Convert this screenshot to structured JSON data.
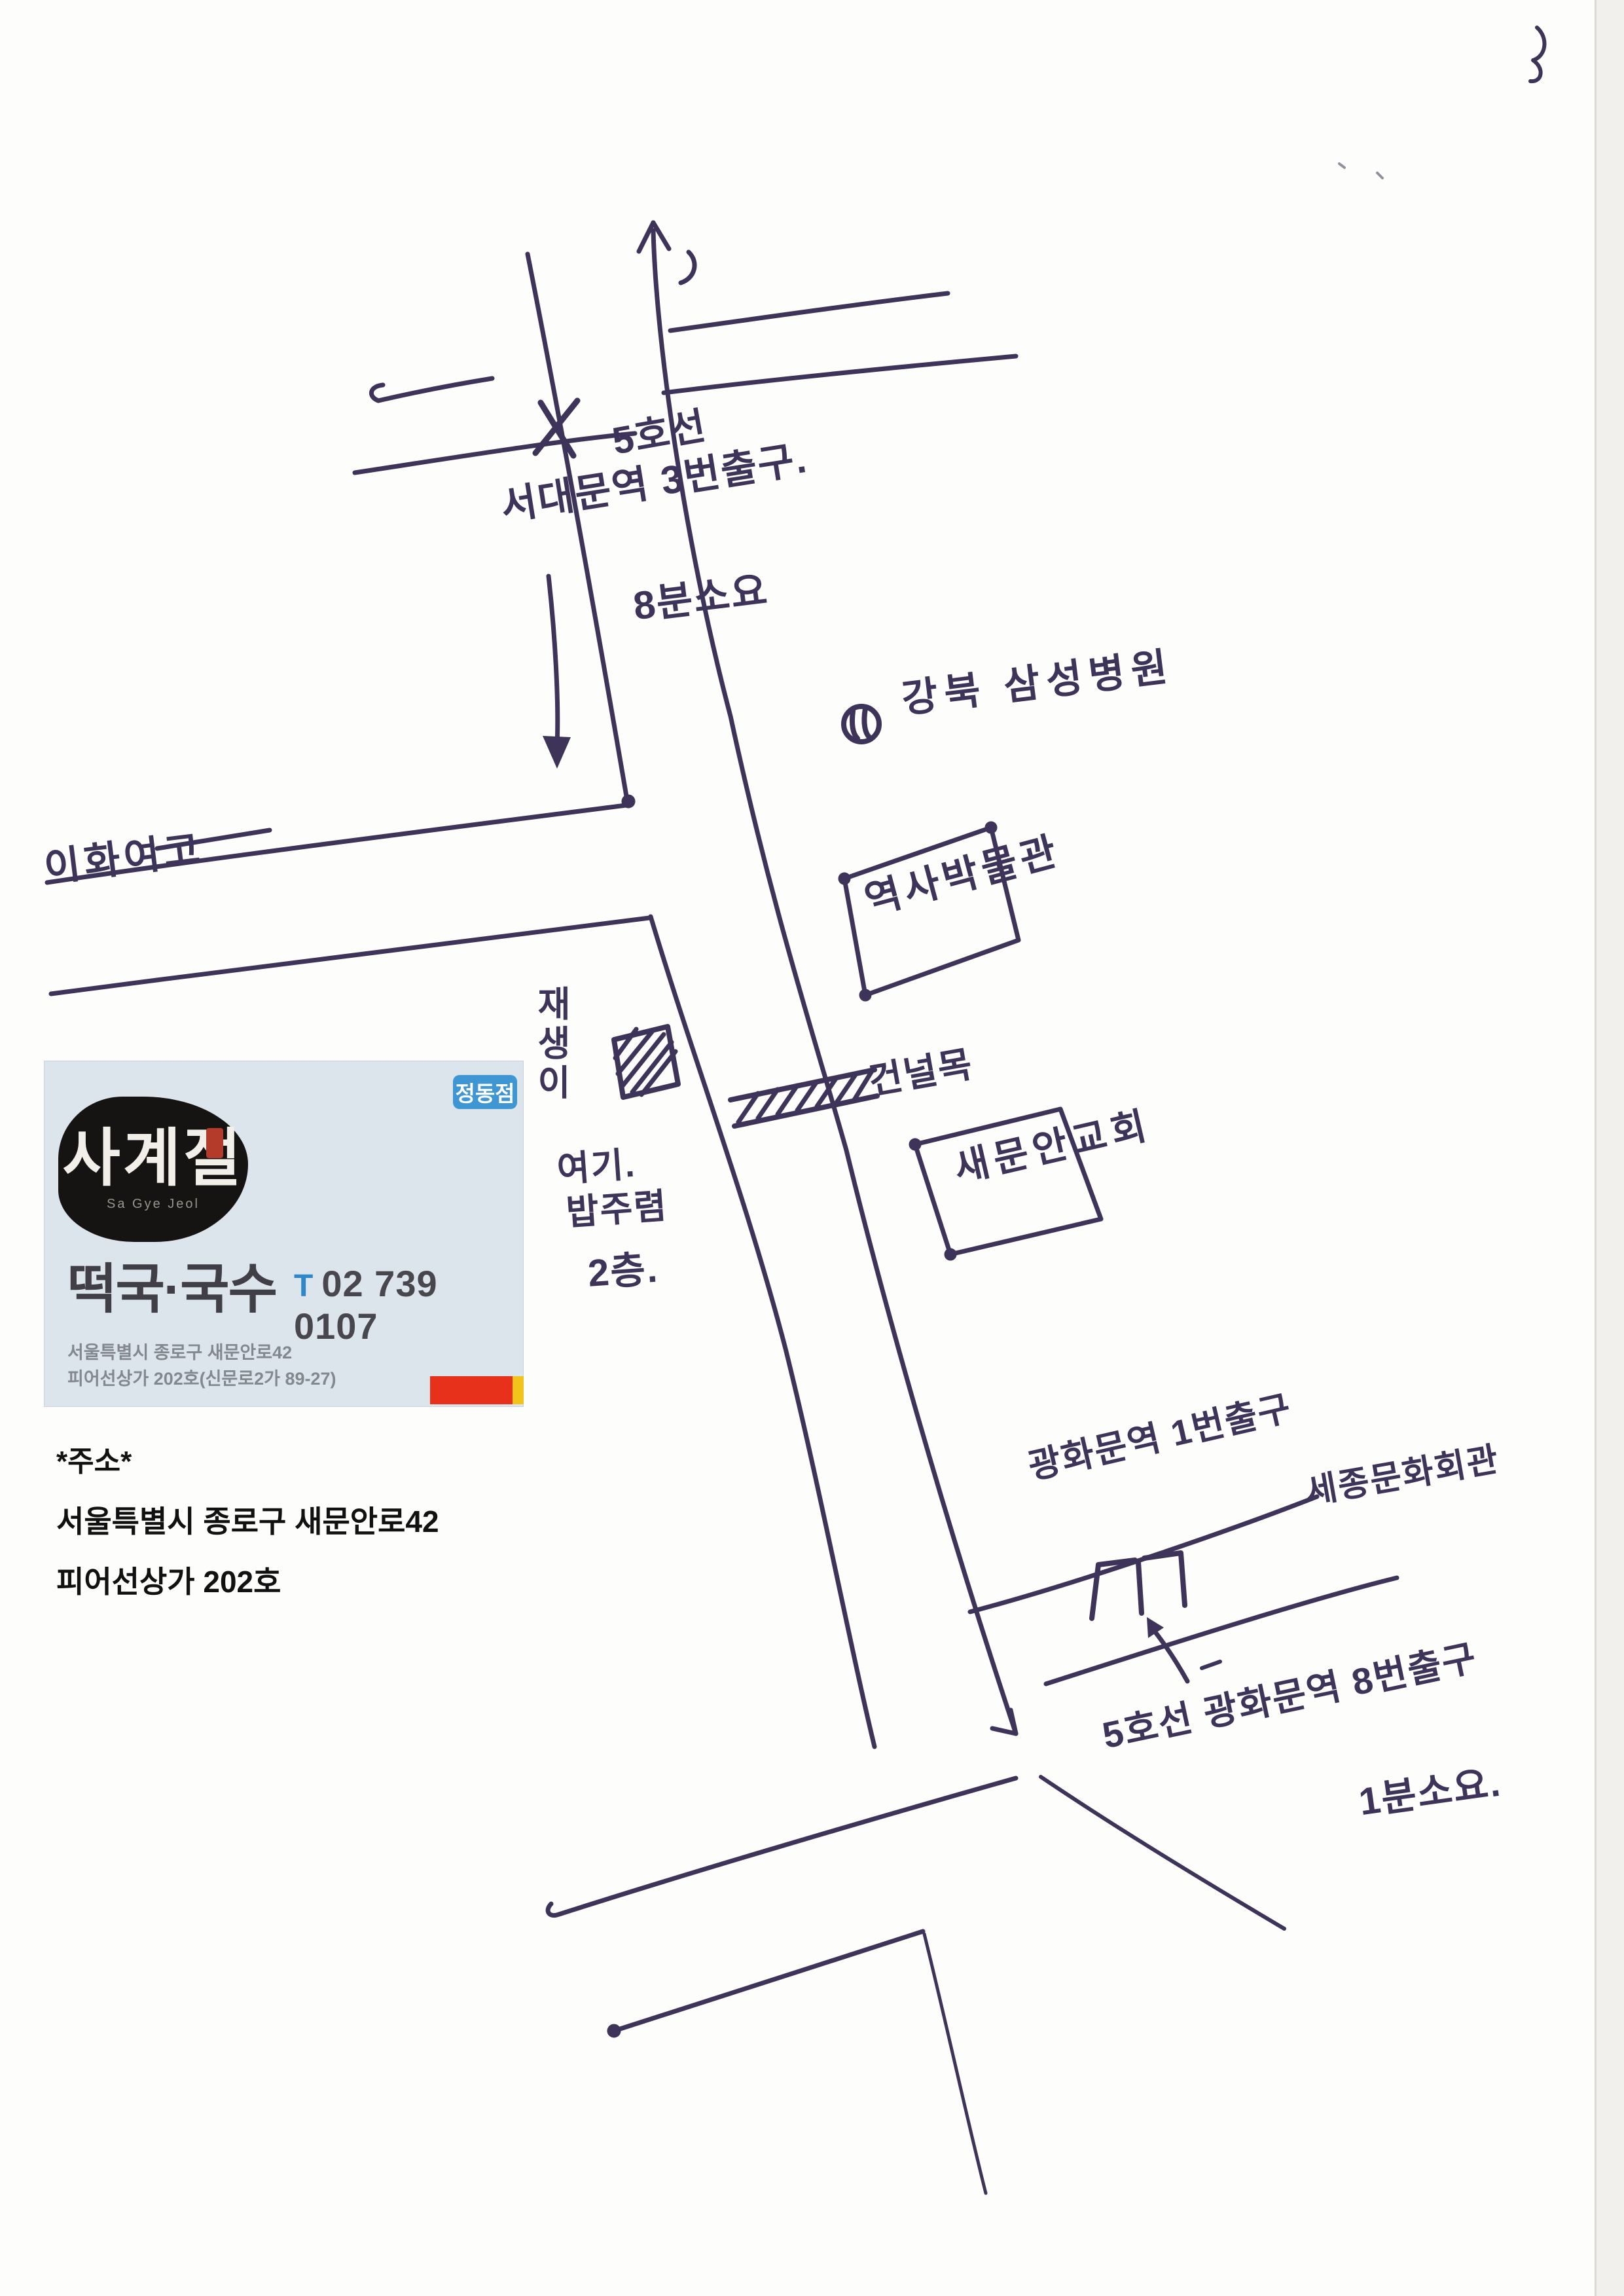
{
  "page": {
    "type": "scanned hand-drawn directions map",
    "paper_color": "#fdfdfb",
    "ink_color": "#3e3358"
  },
  "map": {
    "top_note": {
      "line5": "5호선",
      "station": "서대문역 3번출구.",
      "walk_time": "8분소요"
    },
    "hospital_label": "강북 삼성병원",
    "museum_label": "역사박물관",
    "crosswalk_label": "건널목",
    "church_label": "새문안교회",
    "school_label": "이화여고",
    "destination_note": {
      "vertical_name": "재생이",
      "here": "여기.",
      "name": "밥주렴",
      "floor": "2층."
    },
    "exit1_label": "광화문역 1번출구",
    "sejong_center_label": "세종문화회관",
    "bottom_station": "5호선 광화문역 8번출구",
    "bottom_walk_time": "1분소요.",
    "icons": [
      "hospital-circle-icon",
      "hatched-building-icon",
      "crosswalk-hatch-icon",
      "subway-exit-gate-icon",
      "up-arrow-icon",
      "left-arrow-icon",
      "down-arrow-icon",
      "station-x-mark-icon"
    ]
  },
  "card": {
    "branch_badge": "정동점",
    "logo": "사계절",
    "logo_roman": "Sa Gye Jeol",
    "menu": "떡국·국수",
    "phone_prefix": "T",
    "phone": "02 739 0107",
    "address1": "서울특별시 종로구 새문안로42",
    "address2": "피어선상가 202호(신문로2가 89-27)",
    "colors": {
      "card_bg": "#dde5ec",
      "badge_blue": "#3e96d3",
      "phone_blue": "#2f86c9",
      "accent_red": "#e8311a",
      "accent_yellow": "#f2c318",
      "seal_red": "#b43a2a"
    }
  },
  "address_block": {
    "title": "*주소*",
    "line1": "서울특별시 종로구 새문안로42",
    "line2": "피어선상가 202호"
  }
}
